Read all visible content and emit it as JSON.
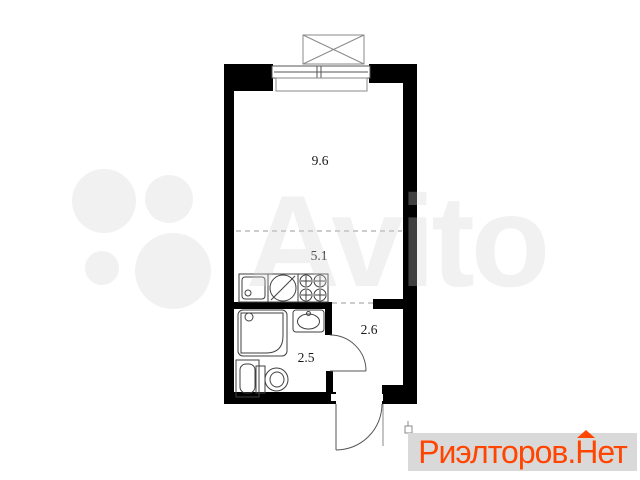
{
  "floor_plan": {
    "room_labels": [
      {
        "id": "living-room",
        "area": "9.6"
      },
      {
        "id": "kitchen-zone",
        "area": "5.1"
      },
      {
        "id": "bathroom",
        "area": "2.5"
      },
      {
        "id": "hallway",
        "area": "2.6"
      }
    ],
    "colors": {
      "wall": "#000000",
      "fixture_line": "#3f3f3f",
      "window_line": "#555555",
      "balcony_line": "#8a8a8a",
      "dashed_line": "#9a9a9a",
      "label_text": "#1a1a1a"
    }
  },
  "watermark": {
    "text": "Avito",
    "color": "rgba(208,208,208,0.30)"
  },
  "logo": {
    "part1": "Риэлторов.",
    "house_letter": "Н",
    "part2": "ет",
    "text_color": "#ff4500",
    "background": "#d9d9d9"
  }
}
